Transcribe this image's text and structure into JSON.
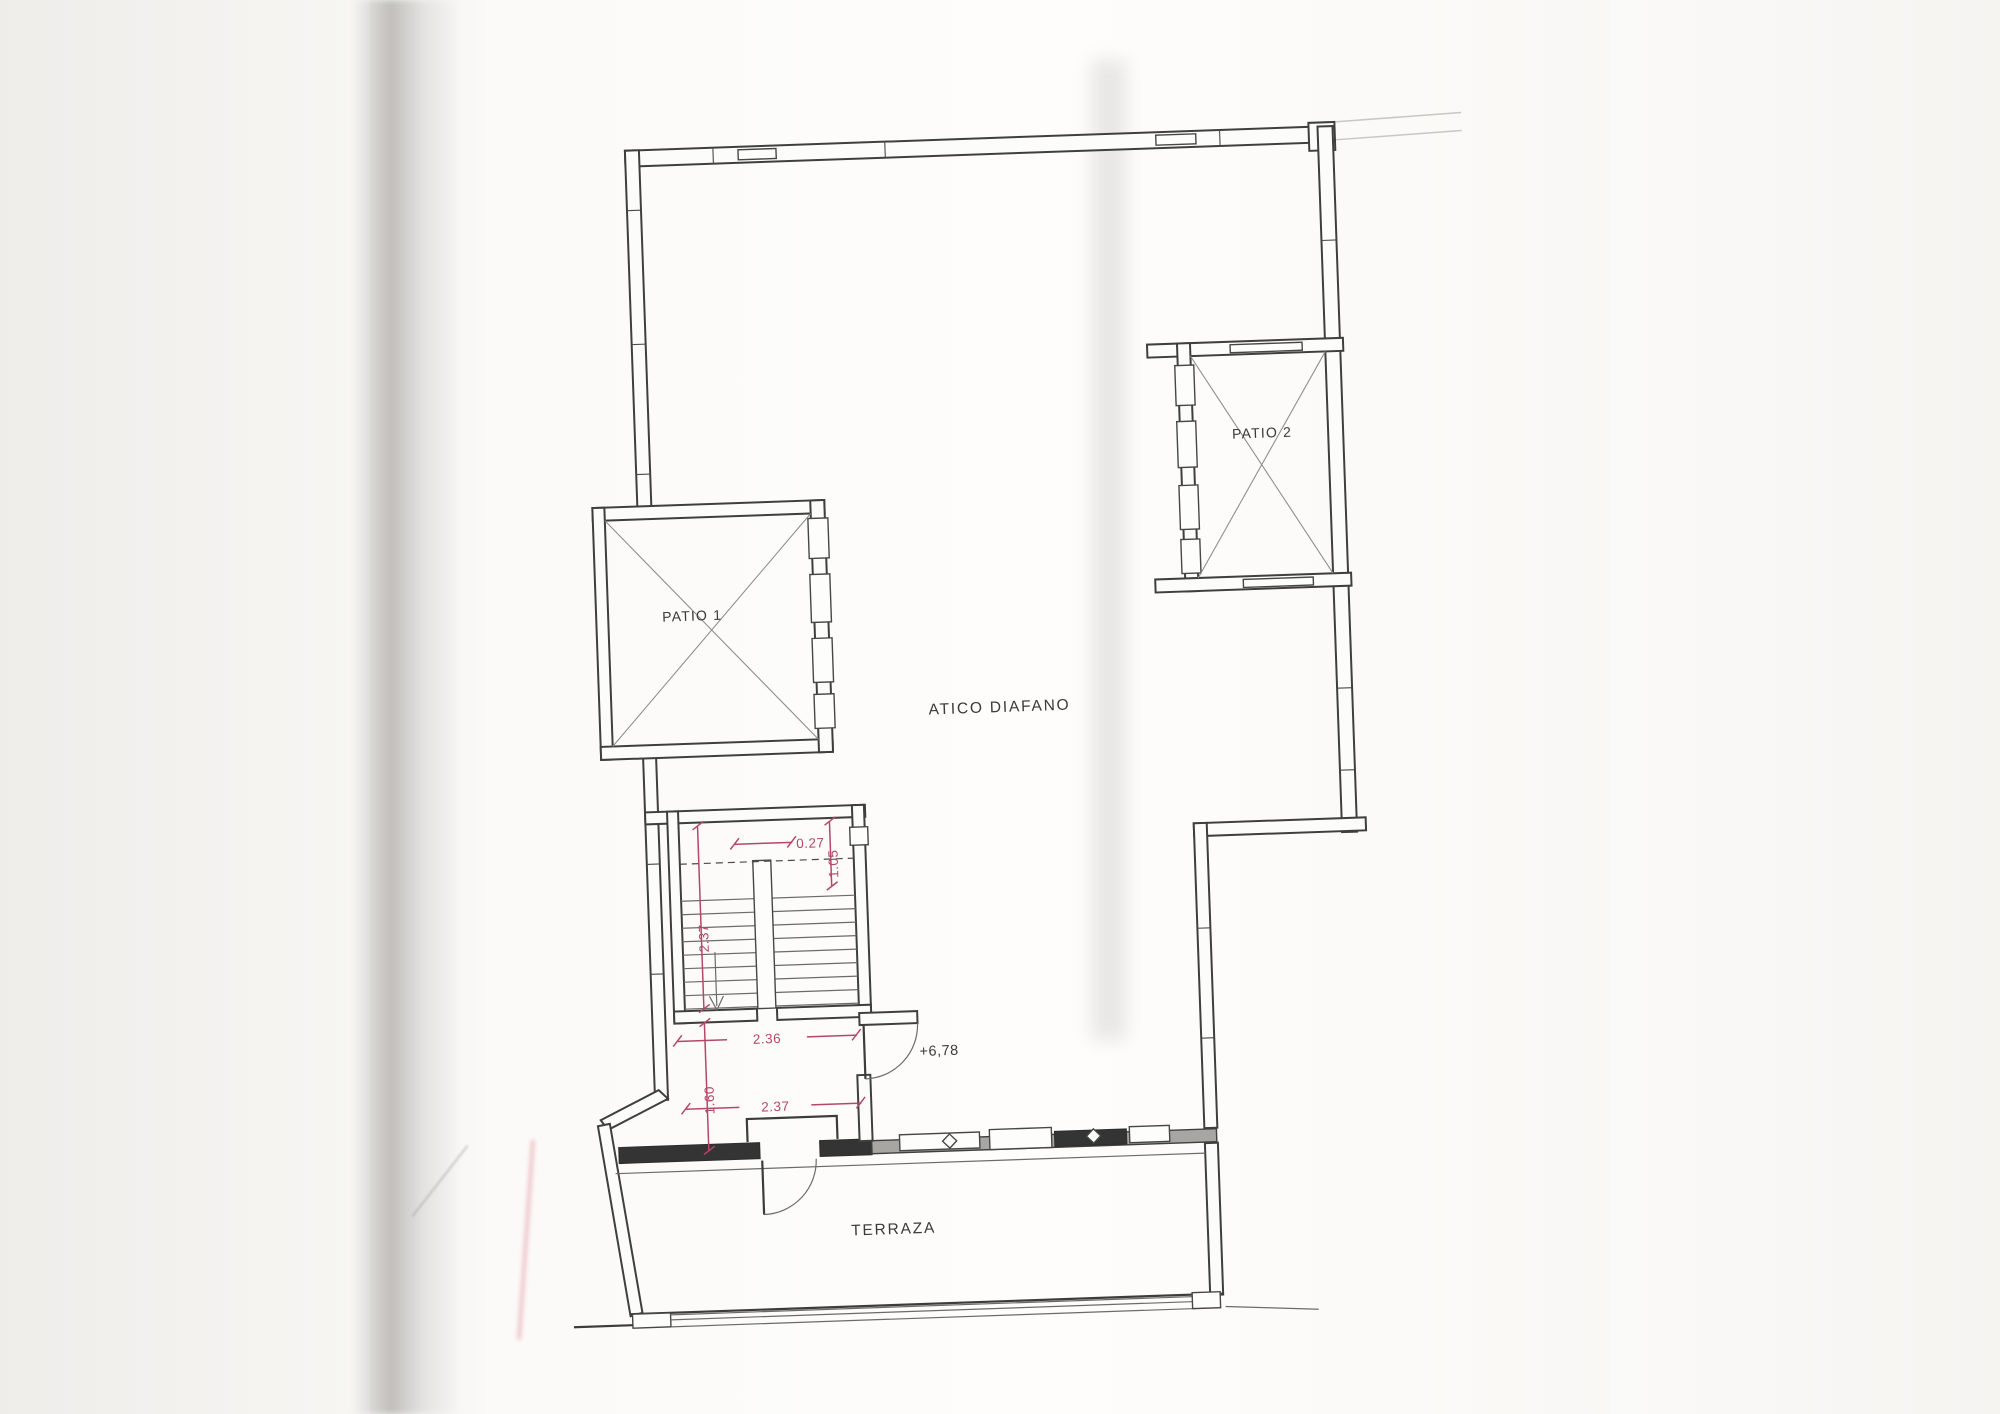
{
  "plan": {
    "labels": {
      "patio1": "PATIO 1",
      "patio2": "PATIO 2",
      "atico": "ATICO DIAFANO",
      "terraza": "TERRAZA",
      "level": "+6,78"
    },
    "dims": {
      "stairTopWidth": "0.27",
      "landingDepth": "1.05",
      "flightLength": "2.37",
      "stairWidth": "2.36",
      "landingLength": "1.60",
      "lowerWidth": "2.37"
    },
    "colors": {
      "wallLine": "#3f3f3f",
      "dimension": "#b4486a"
    }
  }
}
